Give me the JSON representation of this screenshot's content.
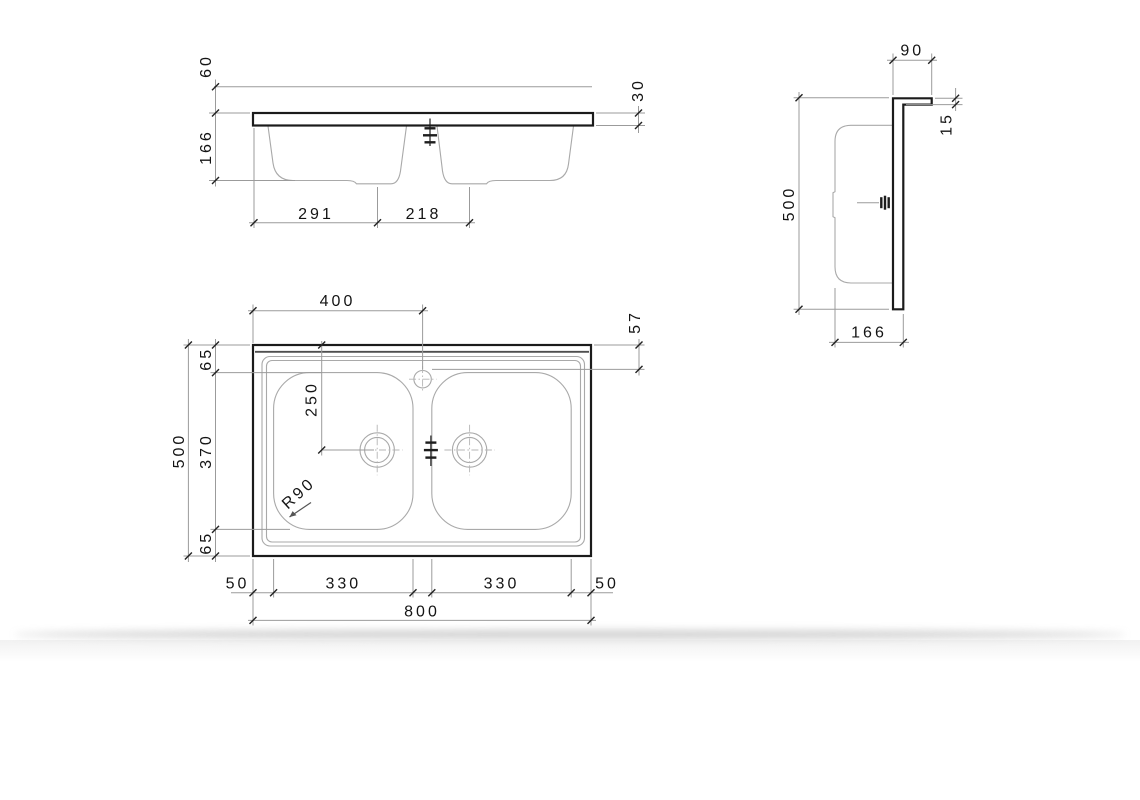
{
  "views": {
    "front": {
      "dim_60": "60",
      "dim_166": "166",
      "dim_291": "291",
      "dim_218": "218",
      "dim_30": "30"
    },
    "side": {
      "dim_90": "90",
      "dim_15": "15",
      "dim_500": "500",
      "dim_166": "166"
    },
    "plan": {
      "dim_400": "400",
      "dim_57": "57",
      "dim_65_top": "65",
      "dim_370": "370",
      "dim_65_bottom": "65",
      "dim_500": "500",
      "dim_250": "250",
      "dim_r90": "R90",
      "dim_50_left": "50",
      "dim_330_left": "330",
      "dim_330_right": "330",
      "dim_50_right": "50",
      "dim_800": "800"
    }
  },
  "colors": {
    "outline": "#1b1b1b",
    "thin_line": "#a9a9a9",
    "dimension_line": "#9b9b9b",
    "text": "#141414",
    "background": "#ffffff"
  }
}
